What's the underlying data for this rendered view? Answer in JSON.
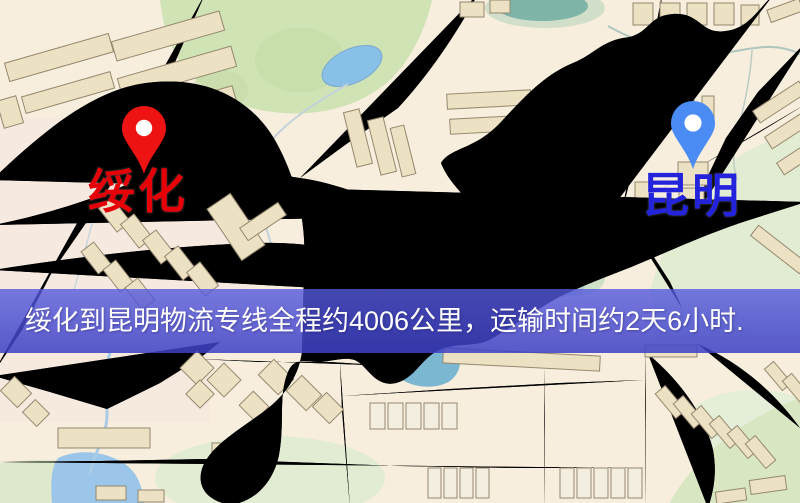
{
  "banner": {
    "text": "绥化到昆明物流专线全程约4006公里，运输时间约2天6小时.",
    "background_color": "#4a4dce",
    "text_color": "#ffffff"
  },
  "markers": {
    "origin": {
      "label": "绥化",
      "label_color": "#e60008",
      "pin_color": "#ee1313"
    },
    "destination": {
      "label": "昆明",
      "label_color": "#2323dc",
      "pin_color": "#4a8cf4"
    }
  },
  "map": {
    "style": "cartoon street map",
    "colors": {
      "background": "#f7eedd",
      "road_fill": "#f6cf6e",
      "road_casing": "#e6b158",
      "park_green": "#cfe3b5",
      "water_blue": "#9cc6e9",
      "building_tan": "#ece1c2",
      "railway_dark": "#2f2f2f"
    }
  }
}
